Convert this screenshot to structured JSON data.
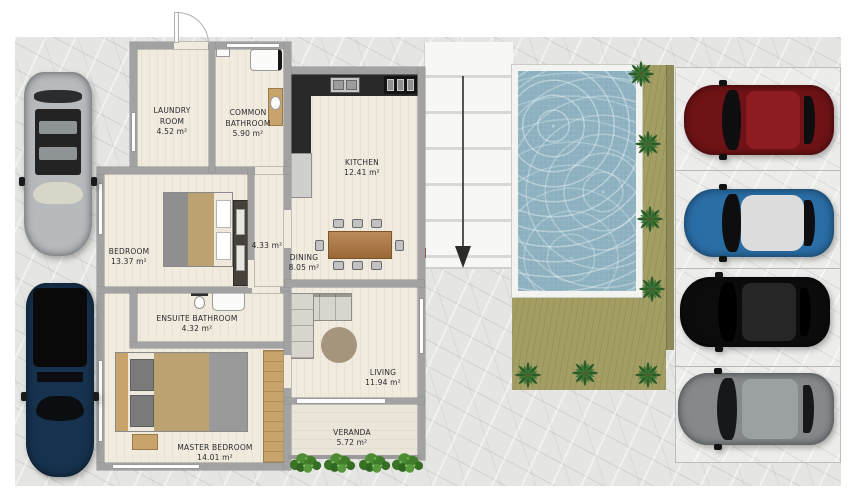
{
  "rooms": [
    {
      "id": "laundry-room",
      "name": "LAUNDRY ROOM",
      "area": "4.52 m²"
    },
    {
      "id": "common-bathroom",
      "name": "COMMON BATHROOM",
      "area": "5.90 m²"
    },
    {
      "id": "kitchen",
      "name": "KITCHEN",
      "area": "12.41 m²"
    },
    {
      "id": "bedroom",
      "name": "BEDROOM",
      "area": "13.37 m²"
    },
    {
      "id": "hallway",
      "name": "",
      "area": "4.33 m²"
    },
    {
      "id": "dining",
      "name": "DINING",
      "area": "8.05 m²"
    },
    {
      "id": "ensuite-bathroom",
      "name": "ENSUITE BATHROOM",
      "area": "4.32 m²"
    },
    {
      "id": "master-bedroom",
      "name": "MASTER BEDROOM",
      "area": "14.01 m²"
    },
    {
      "id": "living",
      "name": "LIVING",
      "area": "11.94 m²"
    },
    {
      "id": "veranda",
      "name": "VERANDA",
      "area": "5.72 m²"
    }
  ],
  "site": {
    "pool_water_color": "#8cb0bf",
    "grass_color": "#a39e63",
    "driveway_arrow_direction": "down",
    "driveway_marker_color": "#ce2b2b",
    "palm_count": 7,
    "veranda_bush_count": 4
  },
  "vehicles": {
    "driveway_left": [
      {
        "name": "silver car with open sunroof",
        "color": "#b6babc"
      },
      {
        "name": "dark blue pickup truck",
        "color": "#16324e"
      }
    ],
    "parking_right": [
      {
        "name": "dark red car",
        "color": "#6f1316"
      },
      {
        "name": "blue car with silver roof",
        "color": "#2a6ea6"
      },
      {
        "name": "black car",
        "color": "#0c0c0c"
      },
      {
        "name": "grey car",
        "color": "#85898b"
      }
    ]
  }
}
